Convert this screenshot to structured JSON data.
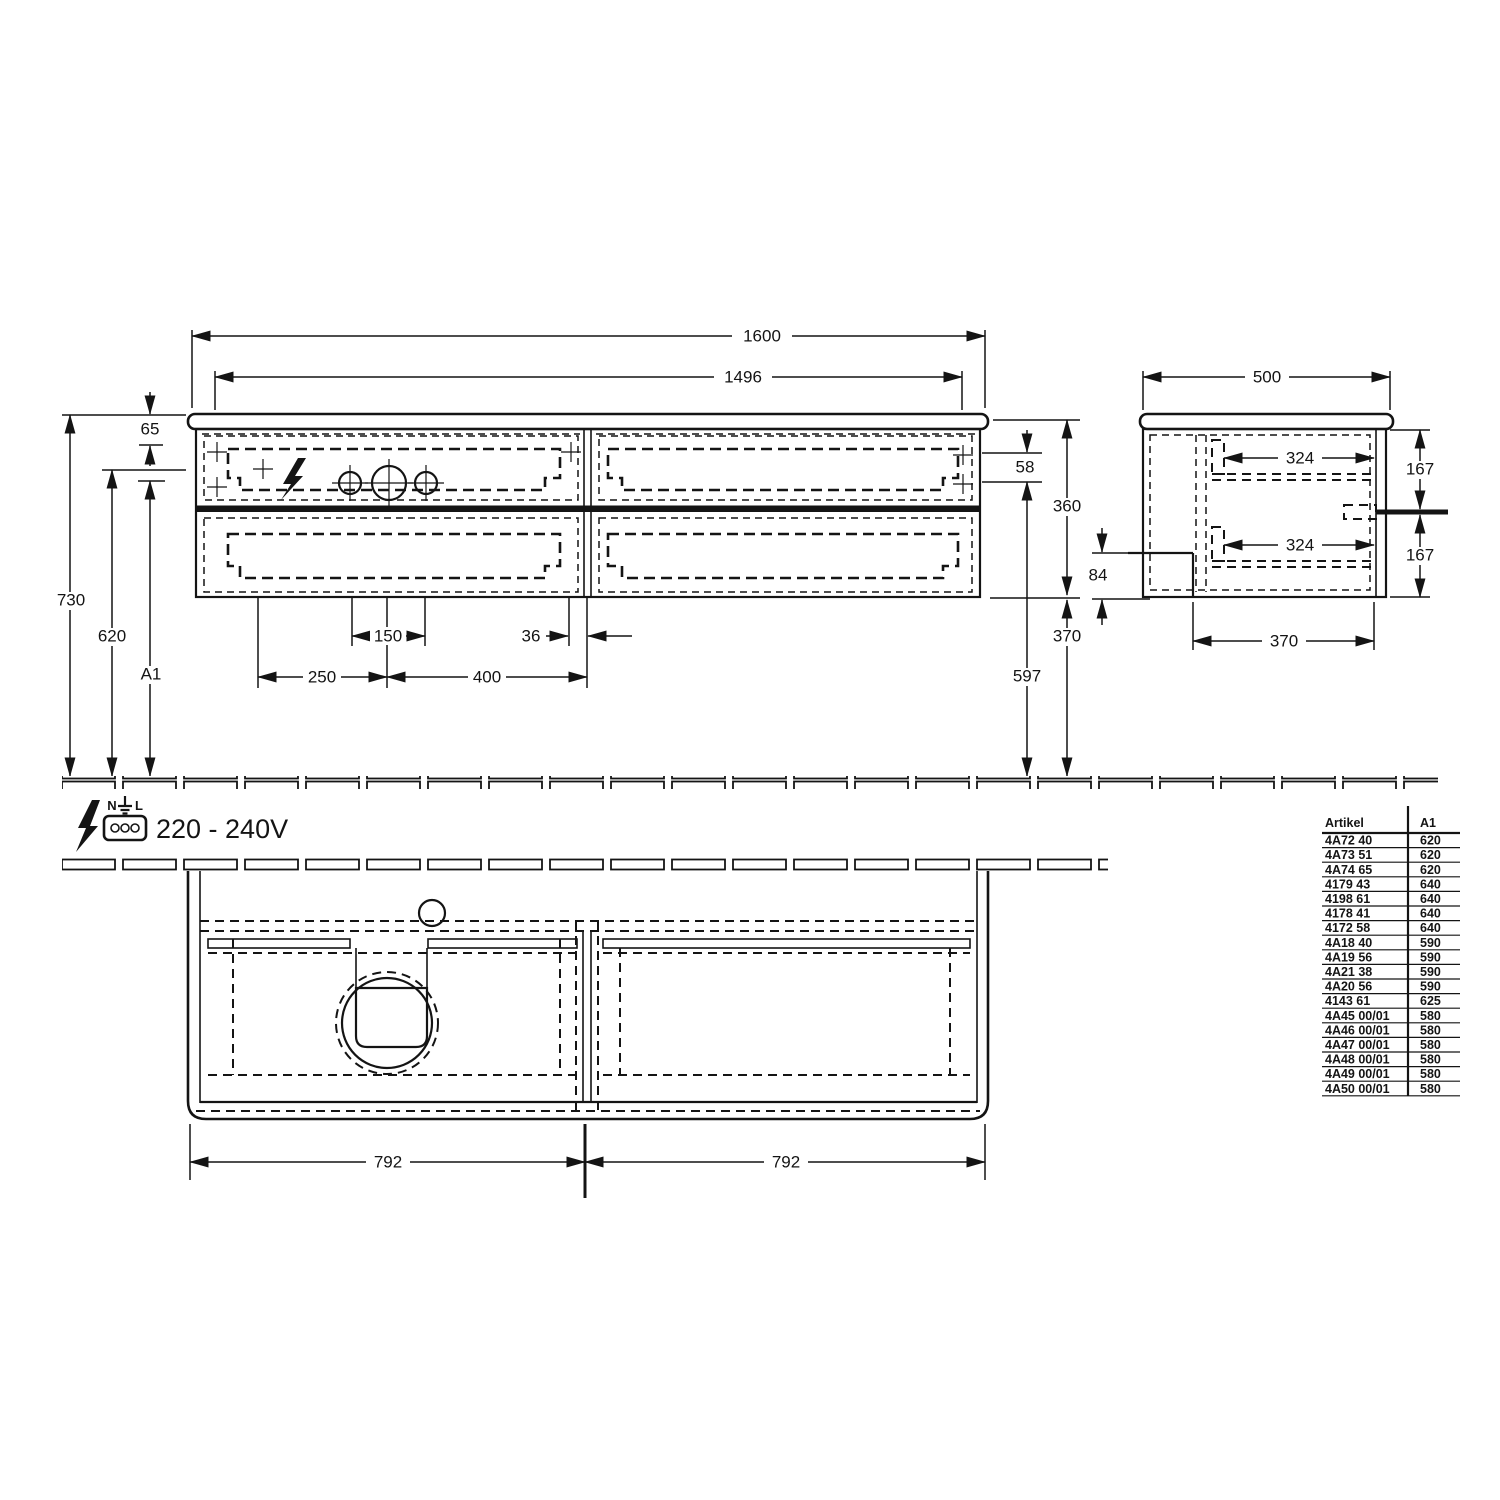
{
  "front_view": {
    "dim_overall_width": "1600",
    "dim_inner_width": "1496",
    "dim_top_offset": "65",
    "dim_total_height": "730",
    "dim_height_620": "620",
    "dim_a1": "A1",
    "dim_drawer_front": "58",
    "dim_cabinet_height": "360",
    "dim_below_cabinet": "370",
    "dim_height_597": "597",
    "dim_hole_span": "150",
    "dim_offset_36": "36",
    "dim_left_250": "250",
    "dim_right_400": "400"
  },
  "side_view": {
    "dim_depth": "500",
    "dim_rail_top": "324",
    "dim_rail_bottom": "324",
    "dim_drawer_top": "167",
    "dim_drawer_bottom": "167",
    "dim_recess": "84",
    "dim_bottom_depth": "370"
  },
  "plan_view": {
    "dim_left_half": "792",
    "dim_right_half": "792"
  },
  "power": {
    "label_n": "N",
    "label_l": "L",
    "voltage": "220 - 240V"
  },
  "article_table": {
    "col_artikel": "Artikel",
    "col_a1": "A1",
    "rows": [
      {
        "a": "4A72 40",
        "v": "620"
      },
      {
        "a": "4A73 51",
        "v": "620"
      },
      {
        "a": "4A74 65",
        "v": "620"
      },
      {
        "a": "4179 43",
        "v": "640"
      },
      {
        "a": "4198 61",
        "v": "640"
      },
      {
        "a": "4178 41",
        "v": "640"
      },
      {
        "a": "4172 58",
        "v": "640"
      },
      {
        "a": "4A18 40",
        "v": "590"
      },
      {
        "a": "4A19 56",
        "v": "590"
      },
      {
        "a": "4A21 38",
        "v": "590"
      },
      {
        "a": "4A20 56",
        "v": "590"
      },
      {
        "a": "4143 61",
        "v": "625"
      },
      {
        "a": "4A45 00/01",
        "v": "580"
      },
      {
        "a": "4A46 00/01",
        "v": "580"
      },
      {
        "a": "4A47 00/01",
        "v": "580"
      },
      {
        "a": "4A48 00/01",
        "v": "580"
      },
      {
        "a": "4A49 00/01",
        "v": "580"
      },
      {
        "a": "4A50 00/01",
        "v": "580"
      }
    ]
  }
}
